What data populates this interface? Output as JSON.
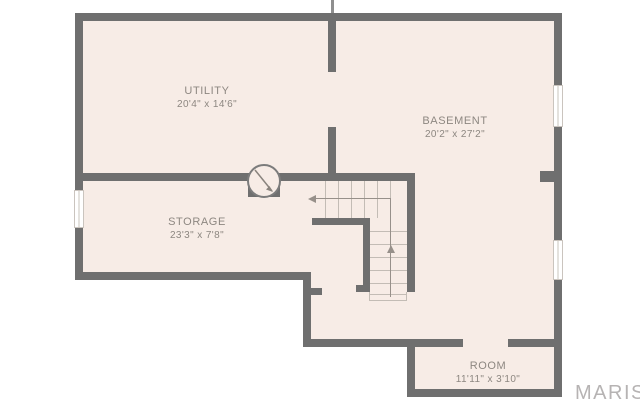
{
  "title": "Basement floor plan",
  "colors": {
    "page-bg": "#ffffff",
    "floor": "#f7ece6",
    "wall": "#6f6f6f",
    "line": "#c3bcb5",
    "guide": "#97908a",
    "label": "#8d8781",
    "window-border": "#cac4be",
    "watermark": "#b6b3b3"
  },
  "rooms": [
    {
      "name": "UTILITY",
      "dims": "20'4\" x 14'6\""
    },
    {
      "name": "BASEMENT",
      "dims": "20'2\" x 27'2\""
    },
    {
      "name": "STORAGE",
      "dims": "23'3\" x 7'8\""
    },
    {
      "name": "ROOM",
      "dims": "11'11\" x 3'10\""
    }
  ],
  "watermark": {
    "text": "MARIS"
  }
}
